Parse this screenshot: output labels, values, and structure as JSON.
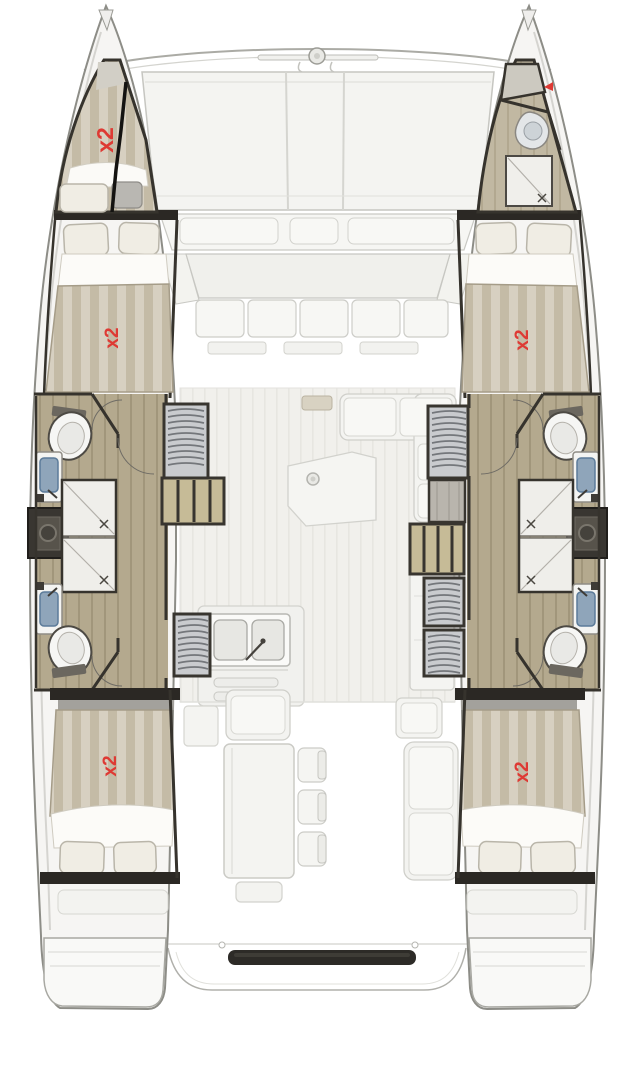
{
  "diagram": {
    "type": "yacht-floor-plan",
    "subject": "catamaran interior layout plan",
    "berth_labels": {
      "bow_crew": "x2",
      "port_forward": "x2",
      "starboard_forward": "x2",
      "port_aft": "x2",
      "starboard_aft": "x2"
    },
    "colors": {
      "label_red": "#de3a34",
      "wall_dark": "#2b2824",
      "wood_floor": "#b4a98e",
      "mattress_light": "#d7d0c1",
      "mattress_dark": "#c4bba6",
      "step_tan": "#c6bb97",
      "louver_gray": "#c9cbce",
      "deck_white": "#f6f5f3",
      "outline_gray": "#8d8d87",
      "sink_blue": "#8fa5ba"
    }
  }
}
